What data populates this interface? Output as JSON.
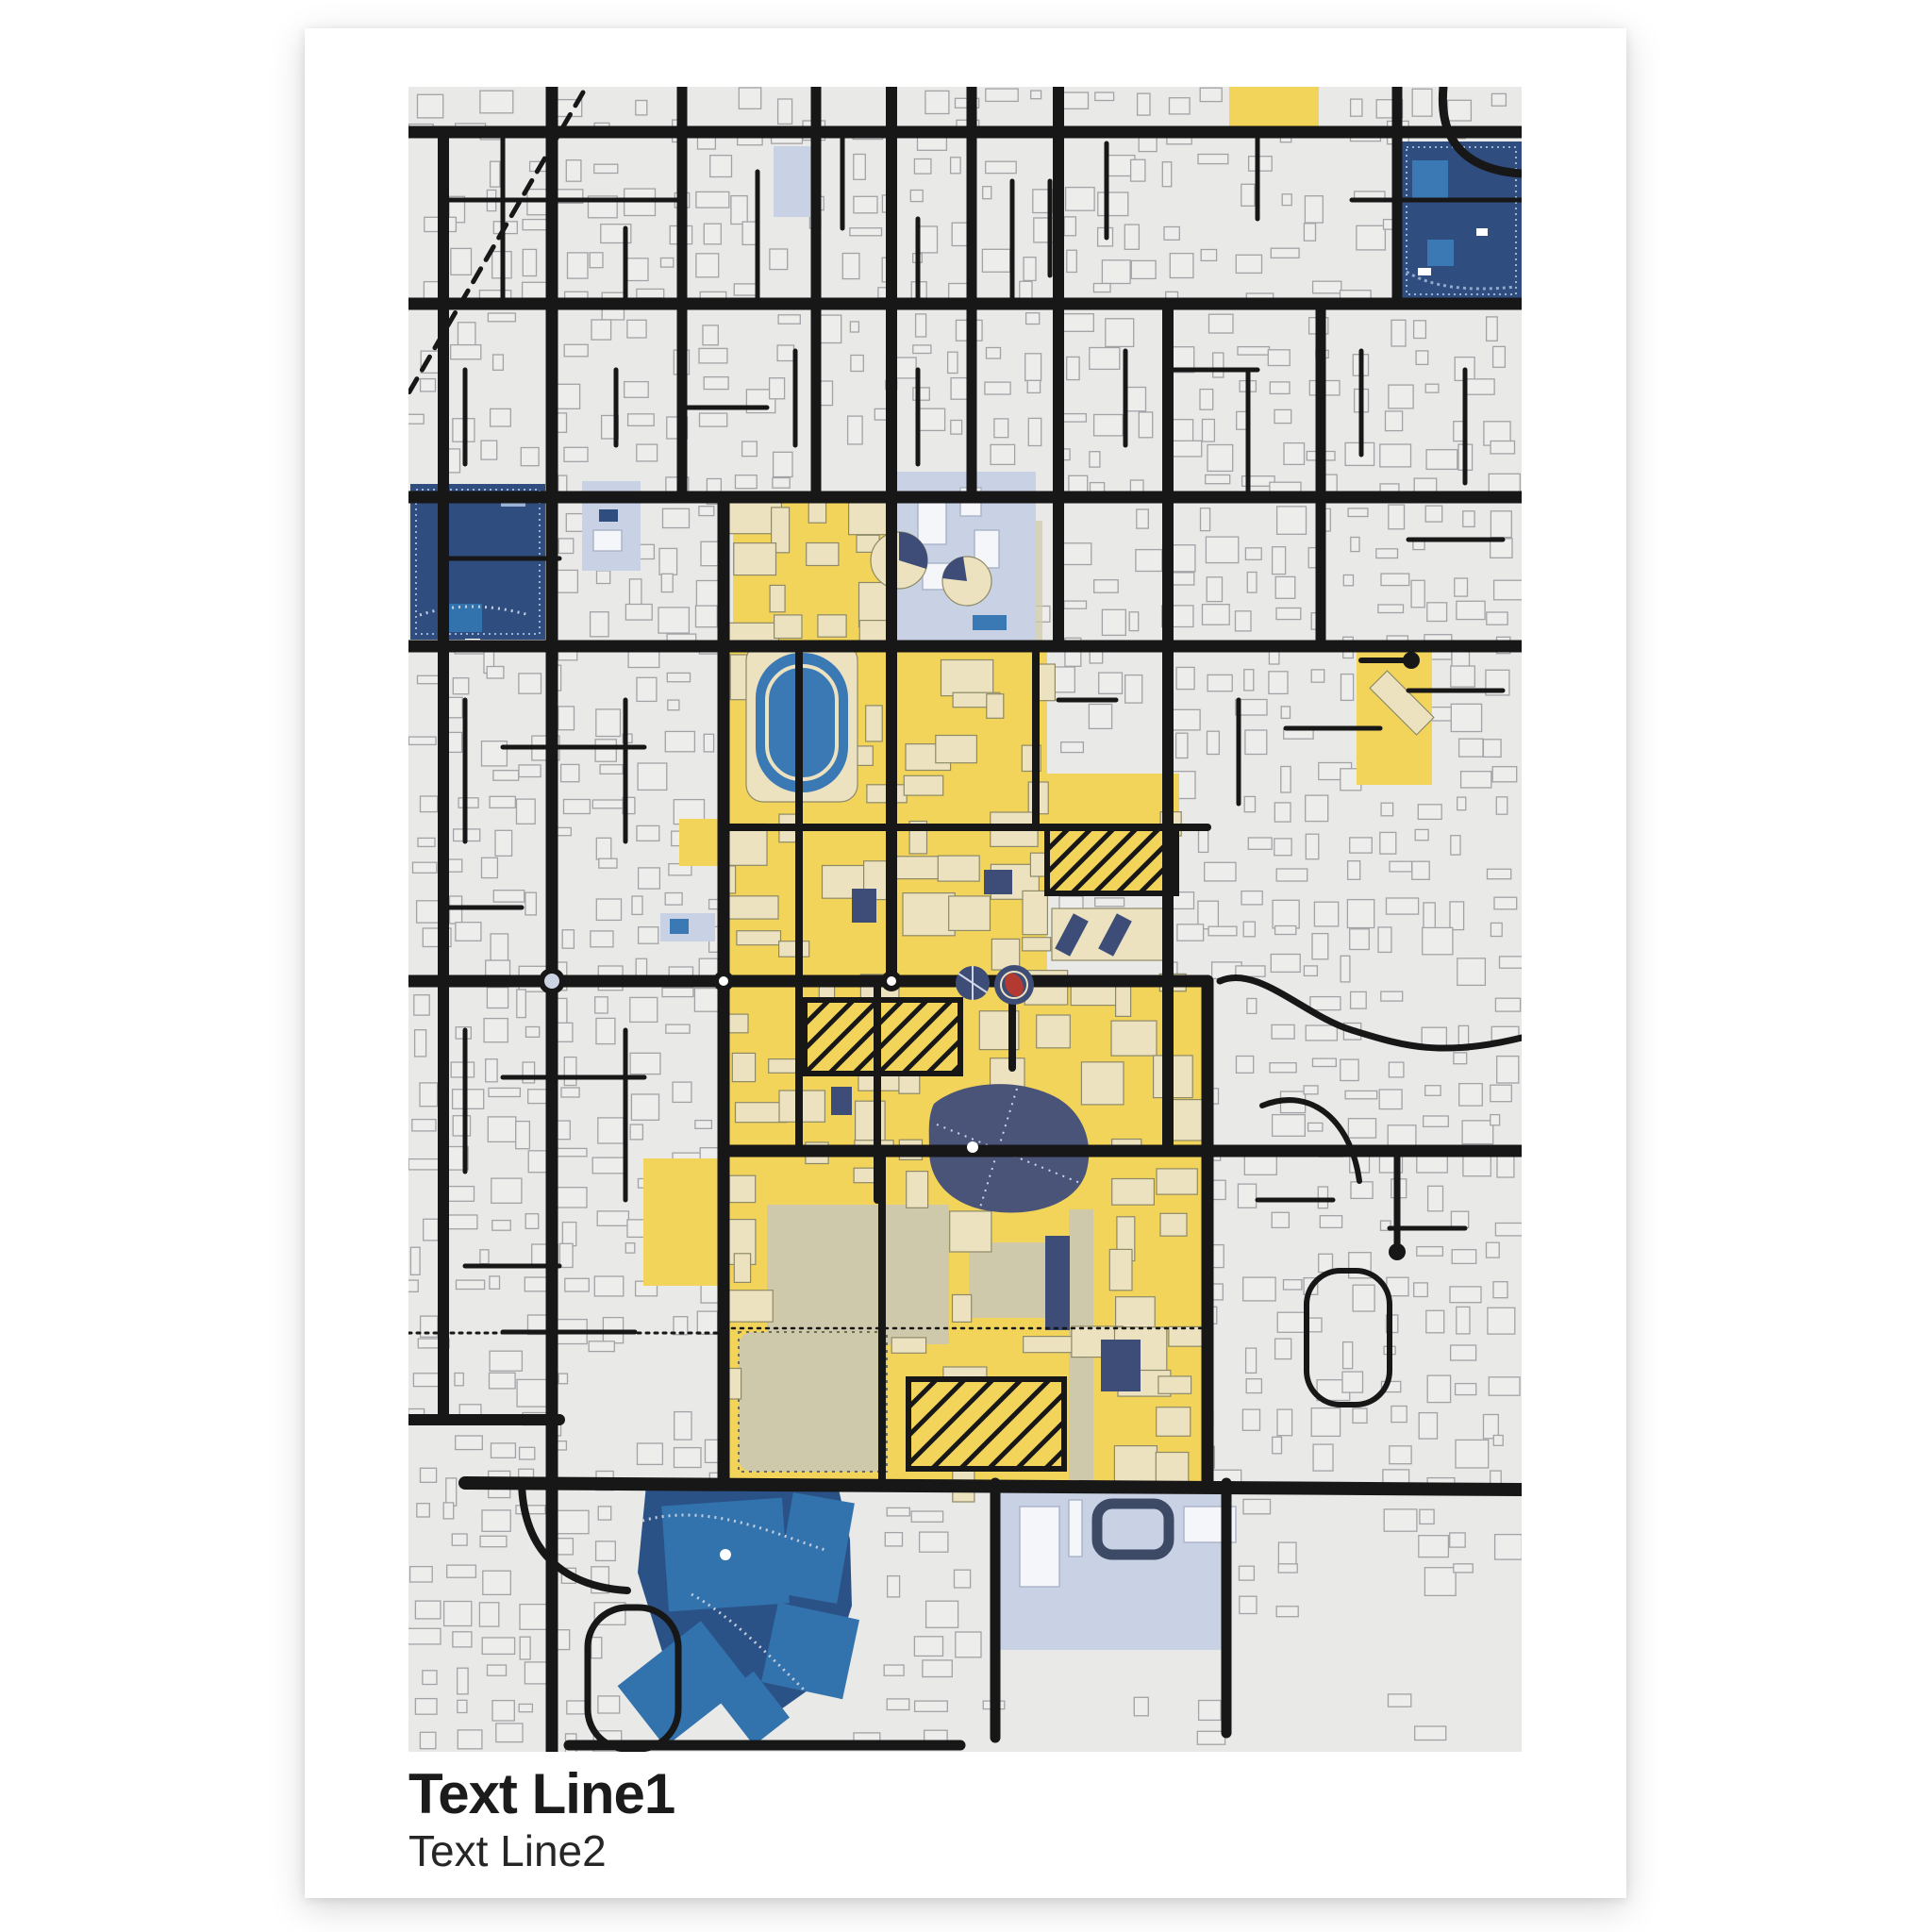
{
  "poster": {
    "title_line1": "Text Line1",
    "title_line2": "Text Line2"
  },
  "map": {
    "description": "stylized-city-campus-street-map",
    "colors": {
      "page-bg": "#ffffff",
      "poster-bg": "#ffffff",
      "map-bg": "#e9e9e7",
      "building": "#ededeb",
      "building-line": "#a3a3a7",
      "road": "#171717",
      "campus-yellow": "#f3d45a",
      "campus-building": "#ece2c0",
      "campus-building-line": "#8e8a68",
      "khaki": "#cfc9ac",
      "navy": "#2f4d7e",
      "navy-dark": "#3e4d77",
      "slate-pond": "#4a5478",
      "lake": "#2b5286",
      "field-blue": "#3273ae",
      "track-blue": "#3a79b4",
      "periwinkle": "#c9d2e4",
      "periwinkle-building": "#f4f6fa",
      "periwinkle-line": "#a8b2c8",
      "light-blue": "#9db4d6",
      "red": "#b23a31",
      "title": "#1b1b1b"
    }
  }
}
